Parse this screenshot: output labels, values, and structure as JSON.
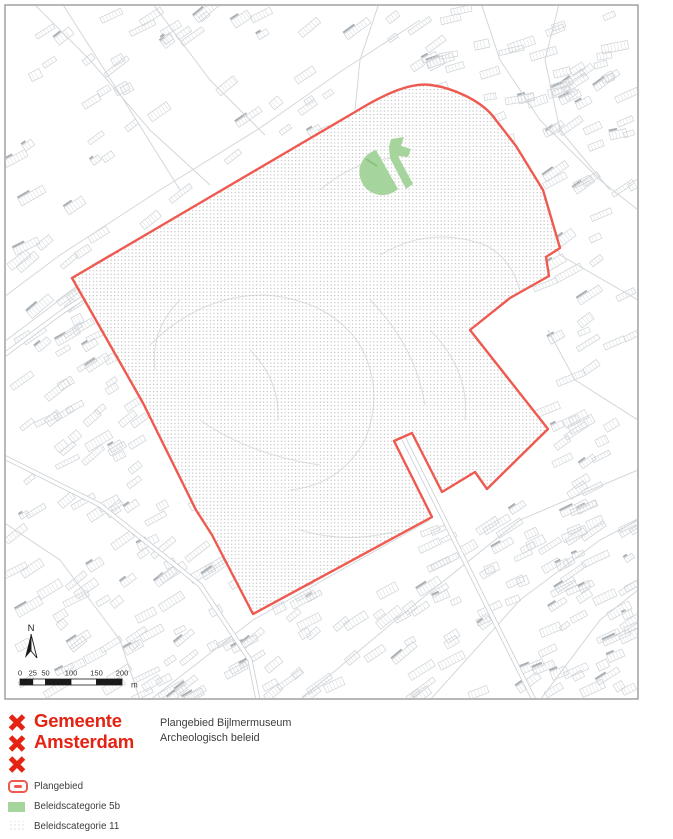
{
  "map": {
    "frame": {
      "x": 5,
      "y": 5,
      "w": 633,
      "h": 694
    },
    "colors": {
      "boundary": "#ee5a50",
      "category5b": "#a5d49c",
      "category5b_accent": "#84bb77",
      "category11_dot": "#bdbdbd",
      "frame_border": "#9a9a9a",
      "street_line": "#cdd2d6",
      "street_tick": "#d8dcdf",
      "street_dark": "#a9afb4",
      "road_line": "#d3d7da",
      "interior_line": "#dcdfe0"
    },
    "plangebied_path": "M72,278 L355,112 C381,96 409,82 431,85 C453,88 479,100 492,115 L516,146 L543,190 L560,248 L546,257 L549,276 L510,298 L470,330 L548,429 L487,489 L475,472 L442,492 L412,433 L394,441 L432,517 L253,614 L212,535 L196,510 L143,403 Z",
    "category5b_paths": [
      "M376,150 A23,23 0 1 0 398,189 Z",
      "M389,147 L391,139 L404,137 L401,146 L411,149 L408,157 L398,156 L413,184 L406,189 L390,158 Z"
    ],
    "north_label": "N",
    "scalebar": {
      "ticks": [
        0,
        25,
        50,
        100,
        150,
        200
      ],
      "unit": "m",
      "px_origin": 20,
      "px_per_m": 0.51
    }
  },
  "footer": {
    "logo": {
      "line1": "Gemeente",
      "line2": "Amsterdam",
      "color": "#e42313"
    },
    "title": {
      "line1": "Plangebied Bijlmermuseum",
      "line2": "Archeologisch beleid"
    },
    "legend": [
      {
        "label": "Plangebied"
      },
      {
        "label": "Beleidscategorie 5b"
      },
      {
        "label": "Beleidscategorie 11"
      }
    ]
  }
}
